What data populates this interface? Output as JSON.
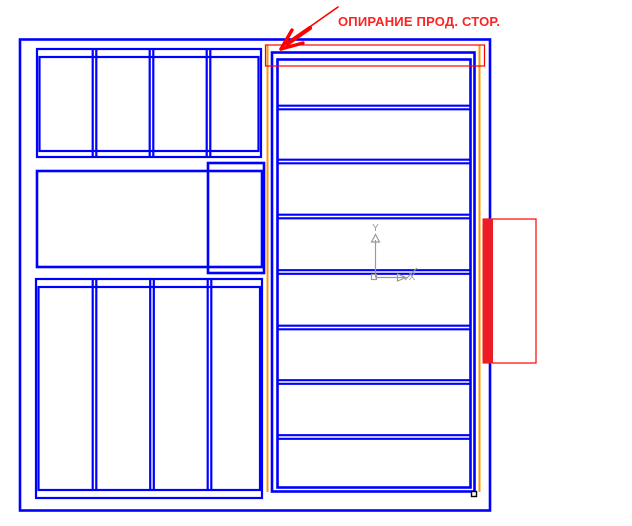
{
  "annotation": {
    "label": "ОПИРАНИЕ ПРОД. СТОР."
  },
  "ucs": {
    "x_label": "X",
    "y_label": "Y"
  },
  "colors": {
    "blue": "#0000FF",
    "red": "#FF0000",
    "text_red": "#FF2222",
    "bar_red": "#EC1C24",
    "orange": "#FF9900",
    "gray": "#9A9A9A",
    "marker_black": "#000000",
    "bg": "#FFFFFF"
  },
  "panels": {
    "left_top_deck": {
      "strips": 4,
      "strip_dividers_x": [
        94.5,
        151.5,
        208.5
      ]
    },
    "left_bottom_deck": {
      "strips": 4,
      "strip_dividers_x": [
        94.5,
        152,
        209.5
      ]
    },
    "right_slab": {
      "rows": 8,
      "row_dividers_y": [
        107.5,
        161.5,
        216.5,
        272,
        327.5,
        382,
        437
      ]
    }
  }
}
